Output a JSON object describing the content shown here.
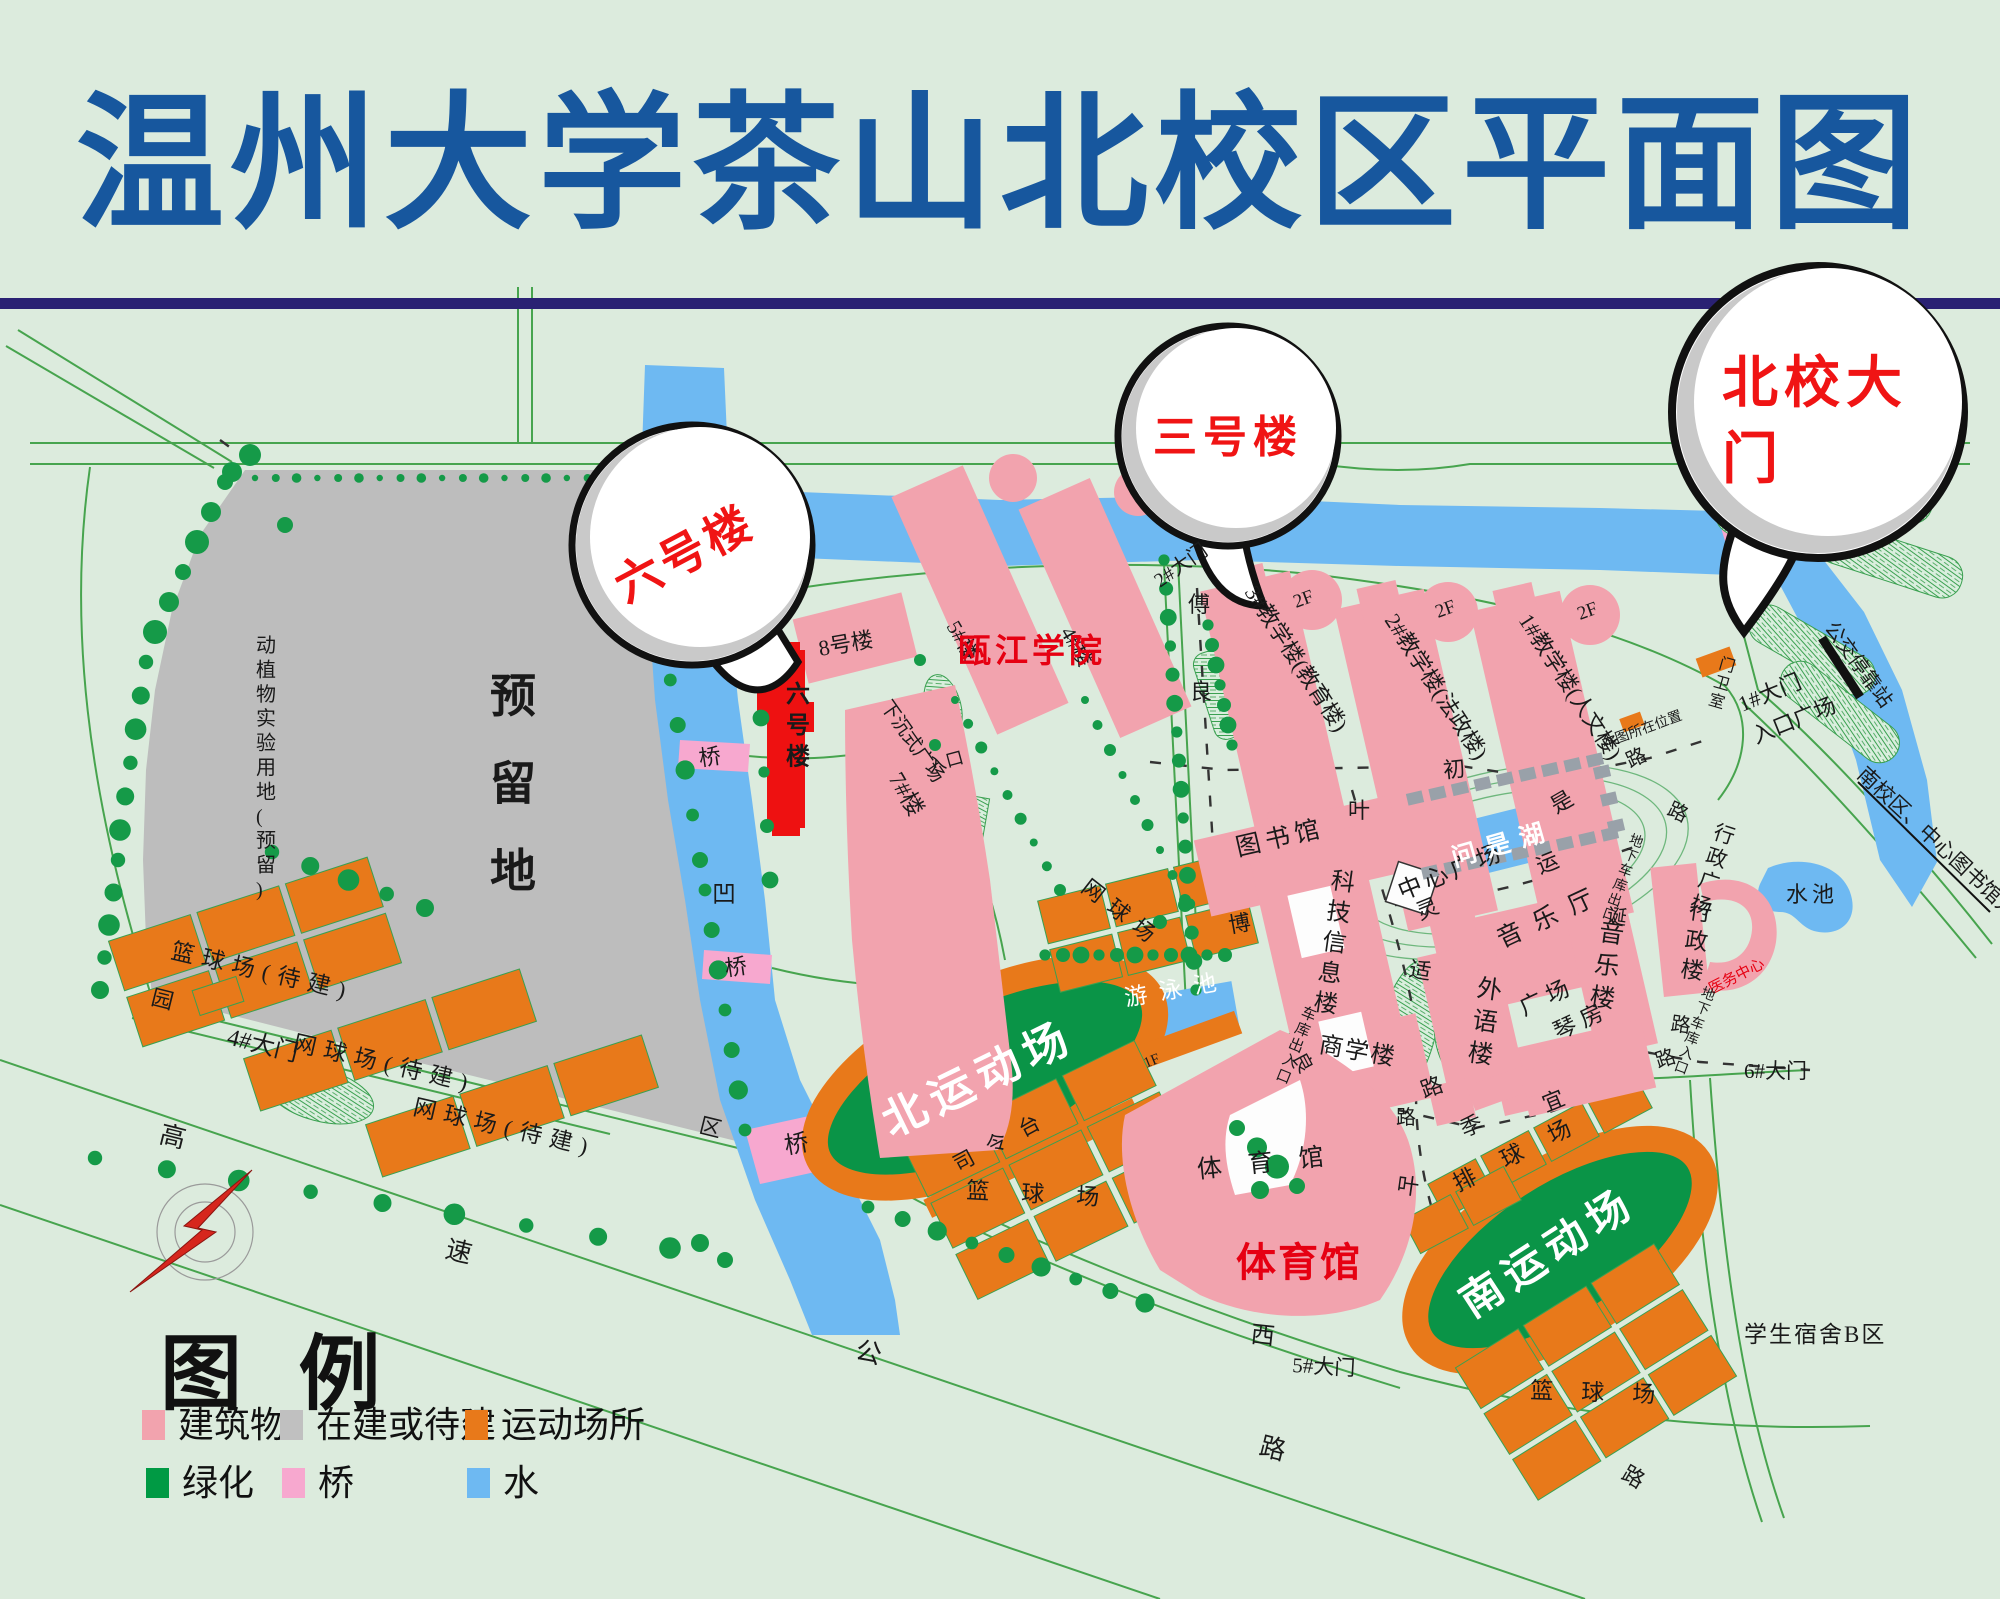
{
  "title": "温州大学茶山北校区平面图",
  "legend": {
    "header": "图  例",
    "items": [
      {
        "label": "建筑物",
        "color": "#F2A3AE"
      },
      {
        "label": "在建或待建",
        "color": "#C0C0C0"
      },
      {
        "label": "运动场所",
        "color": "#E8791A"
      },
      {
        "label": "绿化",
        "color": "#009A44"
      },
      {
        "label": "桥",
        "color": "#F7A8CF"
      },
      {
        "label": "水",
        "color": "#6EB9F2"
      }
    ]
  },
  "bubbles": [
    {
      "name": "callout-building-6",
      "text": "六号楼"
    },
    {
      "name": "callout-building-3",
      "text": "三号楼"
    },
    {
      "name": "callout-north-gate",
      "text": "北校大门"
    }
  ],
  "colors": {
    "building_pink": "#F2A3AE",
    "pending_gray": "#BDBDBD",
    "sports_orange": "#E8791A",
    "green": "#009A44",
    "bridge_pink": "#F7A8CF",
    "water_blue": "#6EB9F2",
    "field_green": "#0A9447",
    "highlight_red": "#EE1111",
    "title_blue": "#17579E",
    "rule_navy": "#2A2173",
    "label_red": "#E60012"
  },
  "labels": [
    {
      "t": "六号楼",
      "x": 692,
      "y": 568,
      "s": 46,
      "c": "#F01414",
      "r": -28,
      "w": 700,
      "sp": 4,
      "a": "middle"
    },
    {
      "t": "三号楼",
      "x": 1228,
      "y": 452,
      "s": 44,
      "c": "#F01414",
      "w": 700,
      "sp": 6,
      "a": "middle"
    },
    {
      "t": "北校大",
      "x": 1722,
      "y": 402,
      "s": 56,
      "c": "#F01414",
      "w": 700,
      "sp": 6
    },
    {
      "t": "门",
      "x": 1722,
      "y": 478,
      "s": 56,
      "c": "#F01414",
      "w": 700
    },
    {
      "t": "预留地",
      "x": 490,
      "y": 712,
      "s": 46,
      "v": 1,
      "lh": 1.9,
      "w": 700
    },
    {
      "t": "动植物实验用地(预留)",
      "x": 256,
      "y": 652,
      "s": 20,
      "v": 1,
      "lh": 1.22
    },
    {
      "t": "8号楼",
      "x": 820,
      "y": 656,
      "s": 22,
      "r": -10
    },
    {
      "t": "7#楼",
      "x": 888,
      "y": 778,
      "s": 23,
      "r": 60
    },
    {
      "t": "六号楼",
      "x": 786,
      "y": 702,
      "s": 24,
      "v": 1,
      "lh": 1.3,
      "w": 700
    },
    {
      "t": "5#楼",
      "x": 946,
      "y": 626,
      "s": 21,
      "r": 60
    },
    {
      "t": "4#楼",
      "x": 1060,
      "y": 632,
      "s": 21,
      "r": 60
    },
    {
      "t": "下沉式广场",
      "x": 880,
      "y": 706,
      "s": 19,
      "r": 55
    },
    {
      "t": "入口",
      "x": 930,
      "y": 772,
      "s": 18,
      "r": -15
    },
    {
      "t": "瓯江学院",
      "x": 958,
      "y": 662,
      "s": 33,
      "c": "#E60012",
      "w": 700,
      "sp": 4
    },
    {
      "t": "3#教学楼(教育楼)",
      "x": 1244,
      "y": 592,
      "s": 22,
      "r": 57
    },
    {
      "t": "2#教学楼(法政楼)",
      "x": 1384,
      "y": 620,
      "s": 22,
      "r": 57
    },
    {
      "t": "1#教学楼(人文楼)",
      "x": 1518,
      "y": 620,
      "s": 22,
      "r": 57
    },
    {
      "t": "2F",
      "x": 1296,
      "y": 608,
      "s": 19,
      "r": -20
    },
    {
      "t": "2F",
      "x": 1438,
      "y": 618,
      "s": 19,
      "r": -20
    },
    {
      "t": "2F",
      "x": 1580,
      "y": 620,
      "s": 19,
      "r": -20
    },
    {
      "t": "图书馆",
      "x": 1238,
      "y": 856,
      "s": 25,
      "r": -13,
      "sp": 5
    },
    {
      "t": "科技信息楼",
      "x": 1330,
      "y": 888,
      "s": 24,
      "v": 1,
      "lh": 1.28,
      "r": 8
    },
    {
      "t": "商学楼",
      "x": 1318,
      "y": 1052,
      "s": 24,
      "r": 10,
      "sp": 2
    },
    {
      "t": "中心广场",
      "x": 1402,
      "y": 900,
      "s": 24,
      "r": -22,
      "sp": 4
    },
    {
      "t": "问是湖",
      "x": 1505,
      "y": 852,
      "s": 25,
      "c": "#FFFFFF",
      "r": -16,
      "sp": 10,
      "w": 700,
      "a": "middle"
    },
    {
      "t": "音乐厅",
      "x": 1502,
      "y": 948,
      "s": 25,
      "r": -25,
      "sp": 14
    },
    {
      "t": "音乐楼",
      "x": 1598,
      "y": 940,
      "s": 25,
      "v": 1,
      "lh": 1.3,
      "r": 8
    },
    {
      "t": "外语楼",
      "x": 1476,
      "y": 996,
      "s": 25,
      "v": 1,
      "lh": 1.3,
      "r": 8
    },
    {
      "t": "广场",
      "x": 1524,
      "y": 1016,
      "s": 23,
      "r": -25,
      "sp": 6
    },
    {
      "t": "琴房",
      "x": 1558,
      "y": 1040,
      "s": 23,
      "r": -25,
      "sp": 6
    },
    {
      "t": "行政楼",
      "x": 1688,
      "y": 918,
      "s": 23,
      "v": 1,
      "lh": 1.28,
      "r": 8
    },
    {
      "t": "医务中心",
      "x": 1712,
      "y": 994,
      "s": 15,
      "c": "#E60012",
      "r": -27
    },
    {
      "t": "行政广场",
      "x": 1712,
      "y": 838,
      "s": 21,
      "v": 1,
      "lh": 1.18,
      "r": 18
    },
    {
      "t": "水池",
      "x": 1786,
      "y": 902,
      "s": 22,
      "sp": 4
    },
    {
      "t": "体育馆",
      "x": 1198,
      "y": 1178,
      "s": 25,
      "sp": 26,
      "r": -6
    },
    {
      "t": "体育馆",
      "x": 1236,
      "y": 1276,
      "s": 40,
      "c": "#E60012",
      "w": 700,
      "sp": 2
    },
    {
      "t": "游泳池",
      "x": 1126,
      "y": 1006,
      "s": 23,
      "c": "#FFFFFF",
      "r": -10,
      "sp": 12
    },
    {
      "t": "1F",
      "x": 1146,
      "y": 1068,
      "s": 15,
      "r": -22
    },
    {
      "t": "司令台",
      "x": 958,
      "y": 1172,
      "s": 21,
      "r": -28,
      "sp": 16
    },
    {
      "t": "篮球场",
      "x": 966,
      "y": 1198,
      "s": 23,
      "sp": 32,
      "r": 3
    },
    {
      "t": "北运动场",
      "x": 985,
      "y": 1092,
      "s": 44,
      "c": "#FFFFFF",
      "r": -26,
      "sp": 8,
      "w": 700,
      "a": "middle"
    },
    {
      "t": "南运动场",
      "x": 1556,
      "y": 1264,
      "s": 42,
      "c": "#FFFFFF",
      "r": -33,
      "sp": 8,
      "w": 700,
      "a": "middle"
    },
    {
      "t": "排球场",
      "x": 1458,
      "y": 1192,
      "s": 23,
      "r": -27,
      "sp": 30
    },
    {
      "t": "篮球场",
      "x": 1530,
      "y": 1398,
      "s": 23,
      "r": 2,
      "sp": 28
    },
    {
      "t": "学生宿舍B区",
      "x": 1744,
      "y": 1342,
      "s": 23,
      "sp": 2
    },
    {
      "t": "凹",
      "x": 712,
      "y": 902,
      "s": 24
    },
    {
      "t": "桥",
      "x": 700,
      "y": 766,
      "s": 22,
      "r": -8
    },
    {
      "t": "桥",
      "x": 726,
      "y": 976,
      "s": 22,
      "r": -8
    },
    {
      "t": "桥",
      "x": 786,
      "y": 1154,
      "s": 24,
      "r": -10
    },
    {
      "t": "1#大门",
      "x": 1742,
      "y": 712,
      "s": 22,
      "r": -22
    },
    {
      "t": "入口广场",
      "x": 1756,
      "y": 744,
      "s": 22,
      "r": -22
    },
    {
      "t": "门卫室",
      "x": 1718,
      "y": 668,
      "s": 16,
      "v": 1,
      "lh": 1.18,
      "r": 16
    },
    {
      "t": "本图所在位置",
      "x": 1604,
      "y": 748,
      "s": 14,
      "r": -20
    },
    {
      "t": "公交停靠站",
      "x": 1824,
      "y": 628,
      "s": 20,
      "r": 54
    },
    {
      "t": "南校区、中心图书馆方向",
      "x": 1856,
      "y": 776,
      "s": 21,
      "r": 43
    },
    {
      "t": "2#大门",
      "x": 1160,
      "y": 588,
      "s": 20,
      "r": -35
    },
    {
      "t": "4#大门",
      "x": 226,
      "y": 1044,
      "s": 24,
      "r": 14
    },
    {
      "t": "5#大门",
      "x": 1292,
      "y": 1372,
      "s": 21,
      "r": 3
    },
    {
      "t": "6#大门",
      "x": 1744,
      "y": 1078,
      "s": 21
    },
    {
      "t": "车库出入口",
      "x": 1300,
      "y": 1016,
      "s": 15,
      "v": 1,
      "lh": 1.12,
      "r": 22
    },
    {
      "t": "地下车库出口",
      "x": 1628,
      "y": 843,
      "s": 14,
      "v": 1,
      "lh": 1.12,
      "r": 20
    },
    {
      "t": "地下车库入口",
      "x": 1700,
      "y": 996,
      "s": 14,
      "v": 1,
      "lh": 1.12,
      "r": 20
    },
    {
      "t": "高",
      "x": 158,
      "y": 1142,
      "s": 26,
      "r": 14
    },
    {
      "t": "速",
      "x": 444,
      "y": 1257,
      "s": 26,
      "r": 14
    },
    {
      "t": "公",
      "x": 854,
      "y": 1358,
      "s": 26,
      "r": 14
    },
    {
      "t": "路",
      "x": 1258,
      "y": 1454,
      "s": 26,
      "r": 14
    },
    {
      "t": "园",
      "x": 150,
      "y": 1004,
      "s": 22,
      "r": 14
    },
    {
      "t": "区",
      "x": 698,
      "y": 1132,
      "s": 22,
      "r": 14
    },
    {
      "t": "西",
      "x": 1250,
      "y": 1342,
      "s": 24,
      "r": 6
    },
    {
      "t": "叶",
      "x": 1348,
      "y": 818,
      "s": 22
    },
    {
      "t": "适",
      "x": 1408,
      "y": 976,
      "s": 22,
      "r": 10
    },
    {
      "t": "路",
      "x": 1424,
      "y": 1098,
      "s": 22,
      "r": -20
    },
    {
      "t": "叶",
      "x": 1396,
      "y": 1192,
      "s": 22,
      "r": 8
    },
    {
      "t": "路",
      "x": 1620,
      "y": 1478,
      "s": 22,
      "r": 30
    },
    {
      "t": "灵",
      "x": 1420,
      "y": 920,
      "s": 22,
      "r": -22
    },
    {
      "t": "运",
      "x": 1540,
      "y": 874,
      "s": 22,
      "r": -22
    },
    {
      "t": "初",
      "x": 1444,
      "y": 778,
      "s": 22,
      "r": -6
    },
    {
      "t": "是",
      "x": 1556,
      "y": 814,
      "s": 22,
      "r": -30
    },
    {
      "t": "傅",
      "x": 1188,
      "y": 612,
      "s": 22
    },
    {
      "t": "良",
      "x": 1190,
      "y": 699,
      "s": 22
    },
    {
      "t": "博",
      "x": 1230,
      "y": 933,
      "s": 22,
      "r": -10
    },
    {
      "t": "良",
      "x": 1292,
      "y": 1057,
      "s": 20,
      "r": 62
    },
    {
      "t": "诞",
      "x": 1606,
      "y": 922,
      "s": 20,
      "r": 8
    },
    {
      "t": "路",
      "x": 1670,
      "y": 1030,
      "s": 20,
      "r": 8
    },
    {
      "t": "路",
      "x": 1658,
      "y": 1068,
      "s": 20,
      "r": -18
    },
    {
      "t": "季",
      "x": 1464,
      "y": 1137,
      "s": 22,
      "r": -22
    },
    {
      "t": "宜",
      "x": 1546,
      "y": 1112,
      "s": 22,
      "r": -22
    },
    {
      "t": "路",
      "x": 1396,
      "y": 1124,
      "s": 20
    },
    {
      "t": "路",
      "x": 1630,
      "y": 768,
      "s": 20,
      "r": -25
    },
    {
      "t": "路",
      "x": 1666,
      "y": 814,
      "s": 20,
      "r": 25
    },
    {
      "t": "篮球场(待建)",
      "x": 170,
      "y": 958,
      "s": 23,
      "r": 13,
      "sp": 8
    },
    {
      "t": "网球场(待建)",
      "x": 292,
      "y": 1050,
      "s": 23,
      "r": 13,
      "sp": 8
    },
    {
      "t": "网球场(待建)",
      "x": 412,
      "y": 1114,
      "s": 23,
      "r": 13,
      "sp": 8
    },
    {
      "t": "网球场",
      "x": 1080,
      "y": 890,
      "s": 22,
      "r": 38,
      "sp": 10
    }
  ]
}
